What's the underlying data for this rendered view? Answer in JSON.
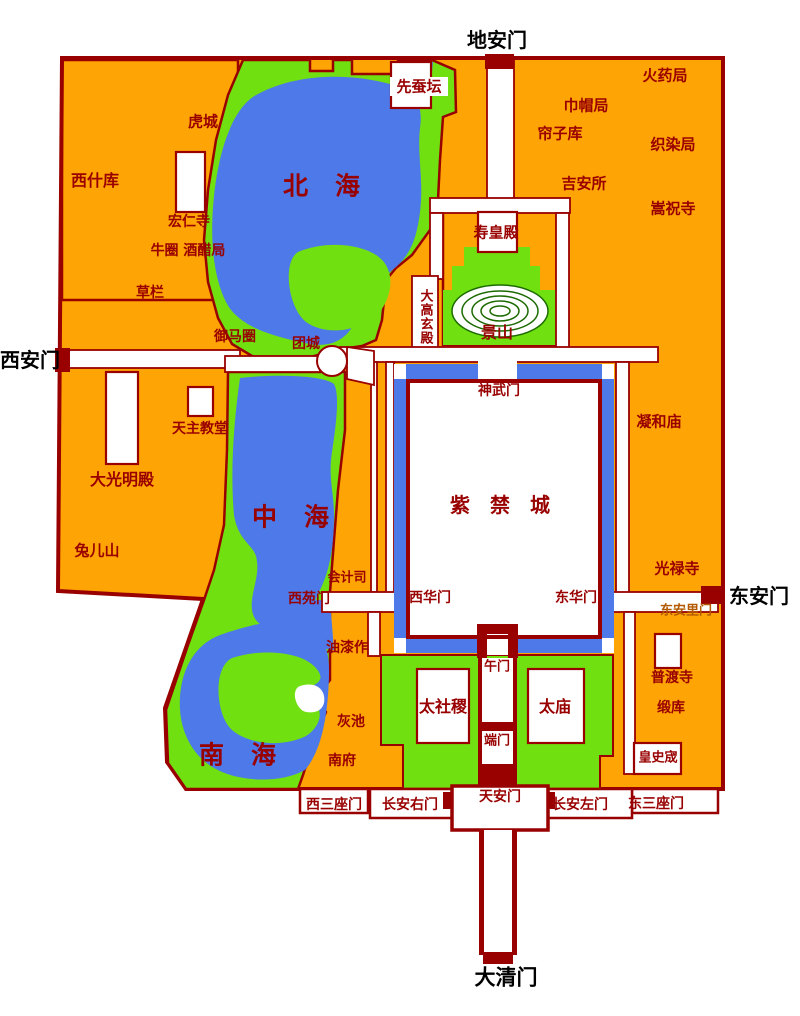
{
  "map": {
    "colors": {
      "city_fill": "#FFA405",
      "park_green": "#70E010",
      "water_blue": "#4E79E8",
      "wall_maroon": "#990000",
      "contour_green": "#1c6a00",
      "outside_label_black": "#000000",
      "minor_gate_label": "#b35900"
    },
    "labels": {
      "di_an_men": "地安门",
      "xian_can_tan": "先蚕坛",
      "huo_yao_ju": "火药局",
      "jin_mao_ju": "巾帽局",
      "lian_zi_ku": "帘子库",
      "zhi_ran_ju": "织染局",
      "hu_cheng": "虎城",
      "xi_shi_ku": "西什库",
      "hong_ren_si": "宏仁寺",
      "niu_juan_jiu_cu_ju": "牛圈 酒醋局",
      "cao_lan": "草栏",
      "ji_an_suo": "吉安所",
      "song_zhu_si": "嵩祝寺",
      "bei_hai": "北　海",
      "shou_huang_dian": "寿皇殿",
      "da_gao_xuan_dian": "大高玄殿",
      "jing_shan": "景山",
      "yu_ma_juan": "御马圈",
      "tuan_cheng": "团城",
      "xi_an_men": "西安门",
      "shen_wu_men": "神武门",
      "ning_he_miao": "凝和庙",
      "tian_zhu_jiao_tang": "天主教堂",
      "da_guang_ming_dian": "大光明殿",
      "tu_er_shan": "兔儿山",
      "zi_jin_cheng": "紫　禁　城",
      "zhong_hai": "中　海",
      "hui_ji_si": "会计司",
      "xi_yuan_men": "西苑门",
      "xi_hua_men": "西华门",
      "dong_hua_men": "东华门",
      "guang_lu_si": "光禄寺",
      "dong_an_men": "东安门",
      "dong_an_li_men": "东安里门",
      "you_qi_zuo": "油漆作",
      "wu_men": "午门",
      "pu_du_si": "普渡寺",
      "tai_she_ji": "太社稷",
      "tai_miao": "太庙",
      "duan_ku": "缎库",
      "hui_chi": "灰池",
      "huang_shi_cheng": "皇史宬",
      "nan_fu": "南府",
      "nan_hai": "南　海",
      "duan_men": "端门",
      "xi_san_zuo_men": "西三座门",
      "chang_an_you_men": "长安右门",
      "tian_an_men": "天安门",
      "chang_an_zuo_men": "长安左门",
      "dong_san_zuo_men": "东三座门",
      "da_qing_men": "大清门"
    }
  }
}
